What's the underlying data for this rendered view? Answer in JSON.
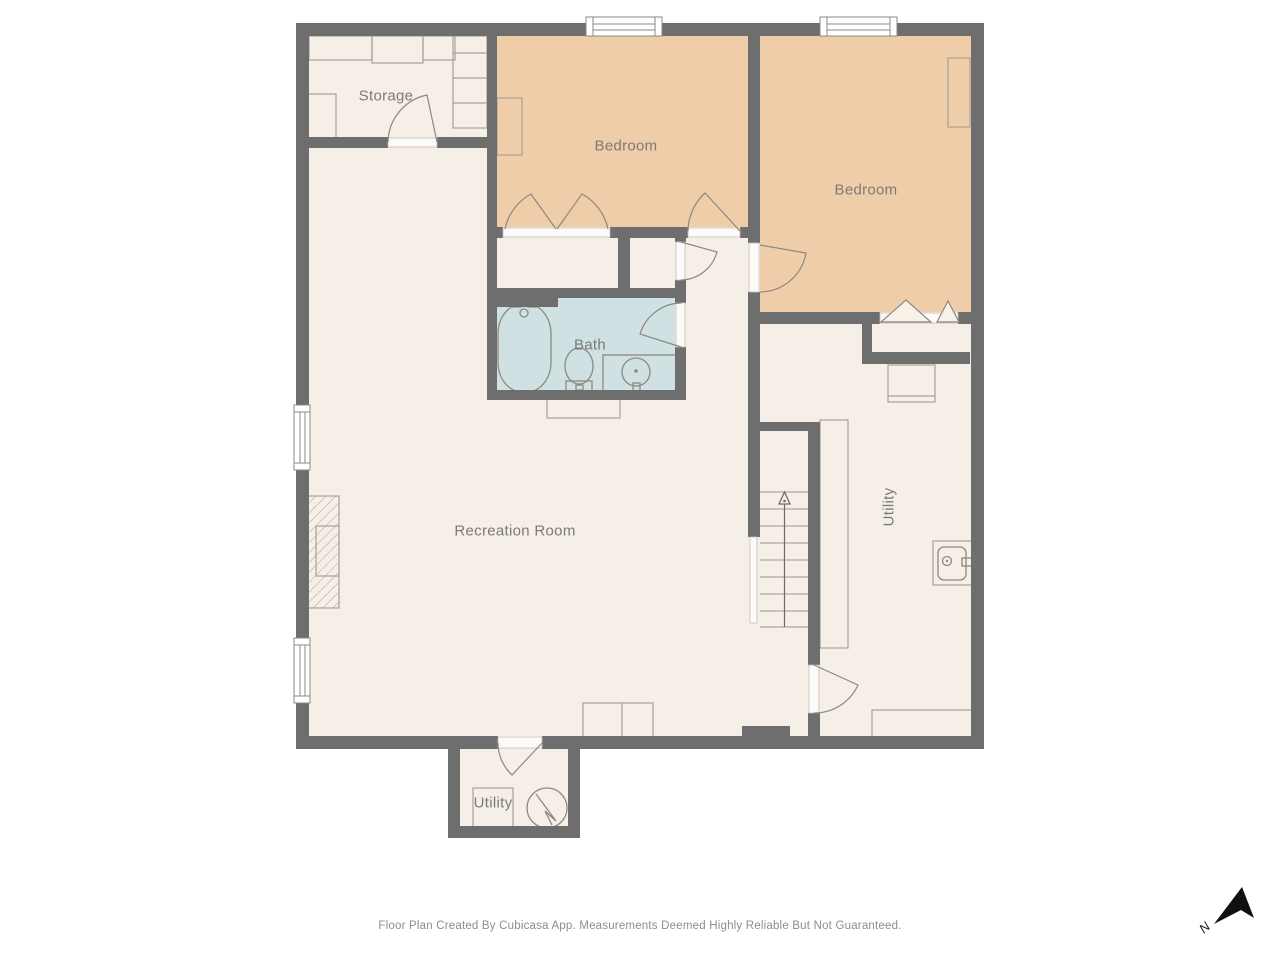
{
  "rooms": {
    "storage": {
      "label": "Storage"
    },
    "bedroom_1": {
      "label": "Bedroom"
    },
    "bedroom_2": {
      "label": "Bedroom"
    },
    "bath": {
      "label": "Bath"
    },
    "recreation": {
      "label": "Recreation Room"
    },
    "utility_main": {
      "label": "Utility"
    },
    "utility_annex": {
      "label": "Utility"
    }
  },
  "footer": {
    "disclaimer": "Floor Plan Created By Cubicasa App. Measurements Deemed Highly Reliable But Not Guaranteed."
  },
  "compass": {
    "label": "N"
  },
  "colors": {
    "wall": "#6e6e6e",
    "floor": "#f5efe8",
    "bedroom_fill": "#f0cda9",
    "bath_fill": "#cfe1e2",
    "furniture_outline": "#a8a296",
    "door_stroke": "#8d8880",
    "label_text": "#7b7b76",
    "footer_text": "#8d8d8d",
    "north_arrow": "#111111"
  }
}
